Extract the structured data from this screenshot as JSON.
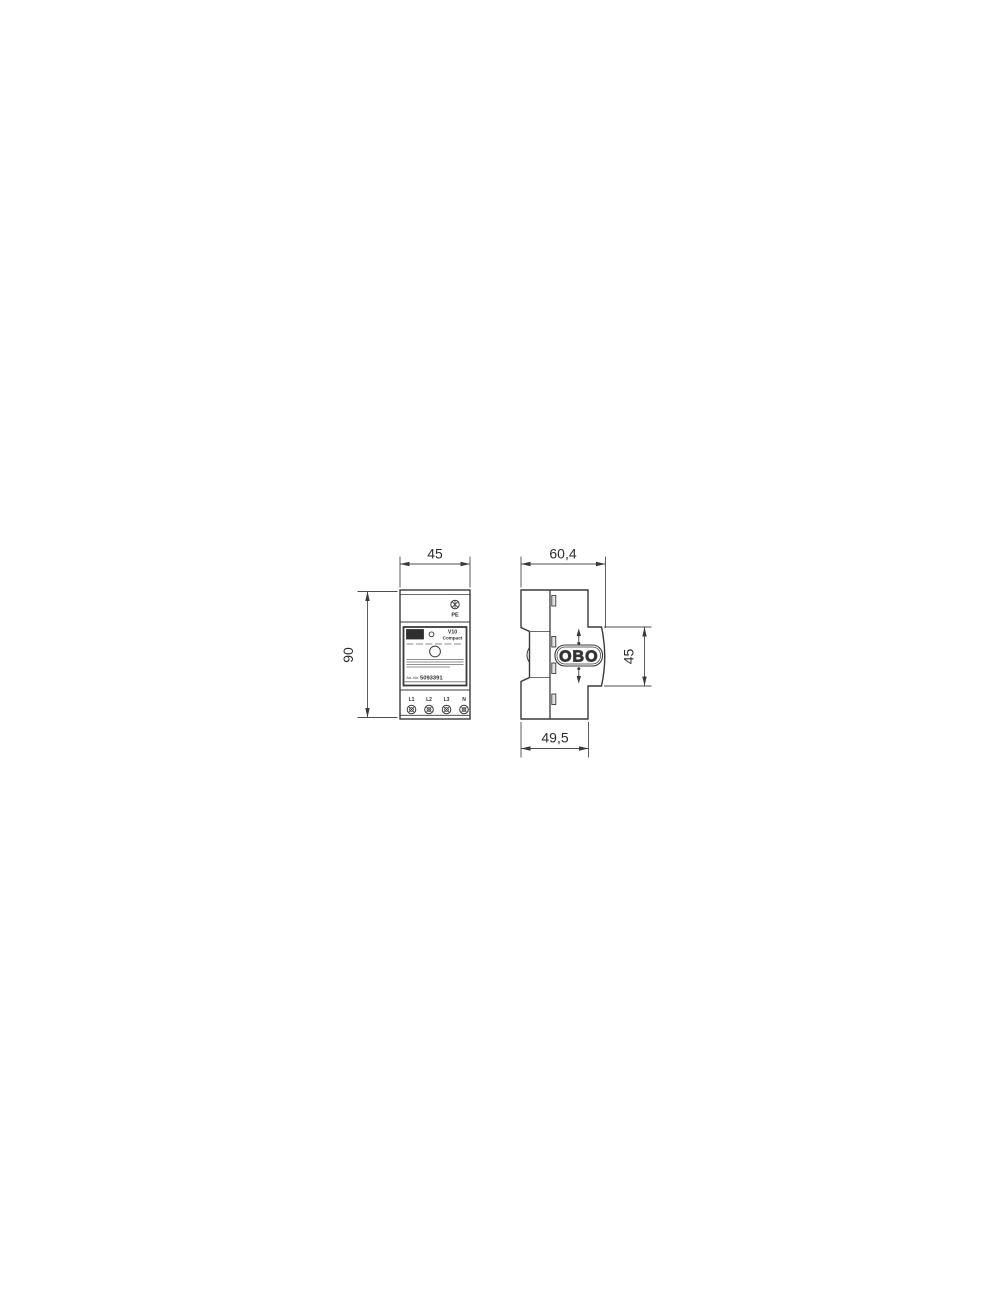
{
  "drawing": {
    "line_color": "#3a3a3a",
    "dim_color": "#4c4c4c",
    "front_view": {
      "dim_width": "45",
      "dim_height": "90",
      "pe_label": "PE",
      "logo": "OBO",
      "product_line1": "V10",
      "product_line2": "Compact",
      "art_prefix": "Art.-No.",
      "art_number": "5093391",
      "terminals": [
        "L1",
        "L2",
        "L3",
        "N"
      ]
    },
    "side_view": {
      "dim_width_top": "60,4",
      "dim_width_bottom": "49,5",
      "dim_height_module": "45",
      "logo": "OBO"
    }
  }
}
